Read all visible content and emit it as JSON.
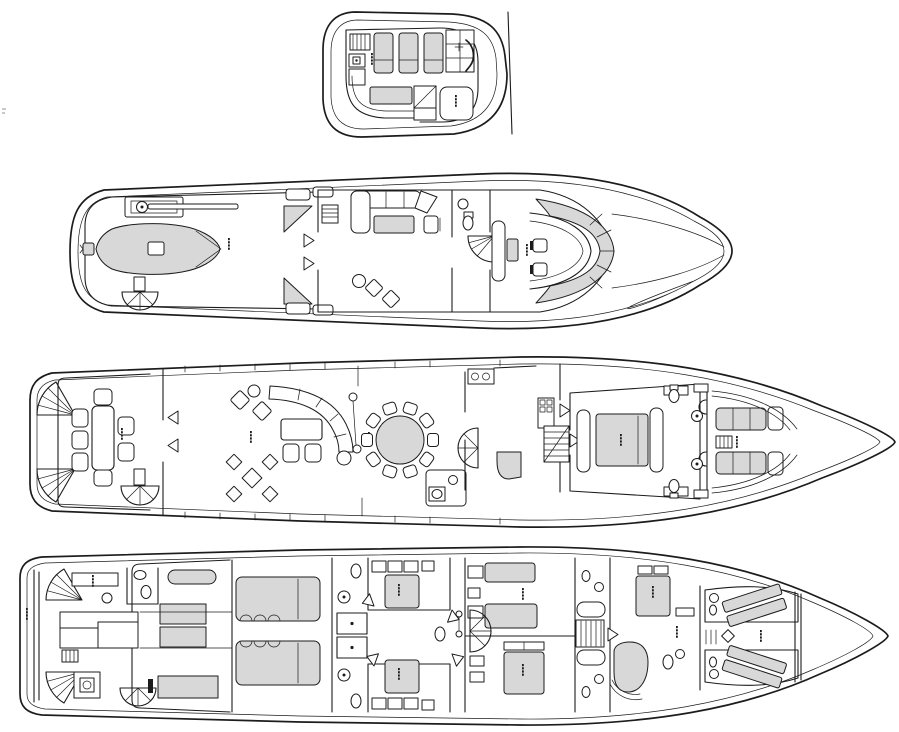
{
  "style": {
    "line": "#1c1c1c",
    "glight": "#d8d8d8",
    "bg": "#ffffff"
  },
  "diagram": {
    "type": "yacht-general-arrangement-plan",
    "orientation": "bow-right",
    "deck_count": 4,
    "decks": [
      {
        "id": "sun-deck",
        "order": 1,
        "elements": {
          "sun_pads": 3,
          "settee_cushion_grid": "2x3",
          "companionway_hatch": 1,
          "console_boxes": 2,
          "bar_table": 1,
          "jacuzzi": 1,
          "windscreen": 1,
          "curved_bench": 1,
          "micro_labels": 2
        }
      },
      {
        "id": "bridge-deck",
        "order": 2,
        "elements": {
          "tender_with_outboard": 1,
          "davit_crane": 1,
          "spiral_stairs": 1,
          "corner_settees": 2,
          "sky_lounge_l_sofa": 1,
          "coffee_table": 1,
          "game_chairs": 2,
          "day_head": 1,
          "curved_stairs": 1,
          "pilothouse_bench": 1,
          "helm_chairs": 2,
          "helm_console": 1,
          "windshield": 1,
          "micro_labels": 2
        }
      },
      {
        "id": "main-deck",
        "order": 3,
        "elements": {
          "stern_fan_stairs": 2,
          "aft_dining_table": 1,
          "aft_dining_chairs": 7,
          "spiral_stairs": 2,
          "salon_curved_sofa": 1,
          "coffee_table": 1,
          "footstools": 2,
          "armchairs": 2,
          "game_table_chairs": 4,
          "bar_columns": 3,
          "round_dining_table": 1,
          "dining_chairs": 10,
          "day_head": 1,
          "galley_stove": 1,
          "stair_flight": 1,
          "master_bed": 1,
          "master_baths": 2,
          "foredeck_settees": 2,
          "bollards": 2,
          "micro_labels": 6
        }
      },
      {
        "id": "lower-deck",
        "order": 4,
        "elements": {
          "swim_platform": 1,
          "stern_fan_stairs": 2,
          "crew_head": 1,
          "crew_mess_berths": 3,
          "laundry": 1,
          "spiral_stairs": 2,
          "generators": 4,
          "main_engines": 2,
          "watertight_doors": 2,
          "guest_double_cabins": 2,
          "guest_twin_beds": 2,
          "guest_double_bed": 1,
          "bathtubs": 2,
          "stair_flight": 1,
          "vip_bed": 1,
          "round_shower": 1,
          "fwd_crew_bunks": 4,
          "collision_bulkhead": 1,
          "micro_labels": 10
        }
      }
    ]
  }
}
